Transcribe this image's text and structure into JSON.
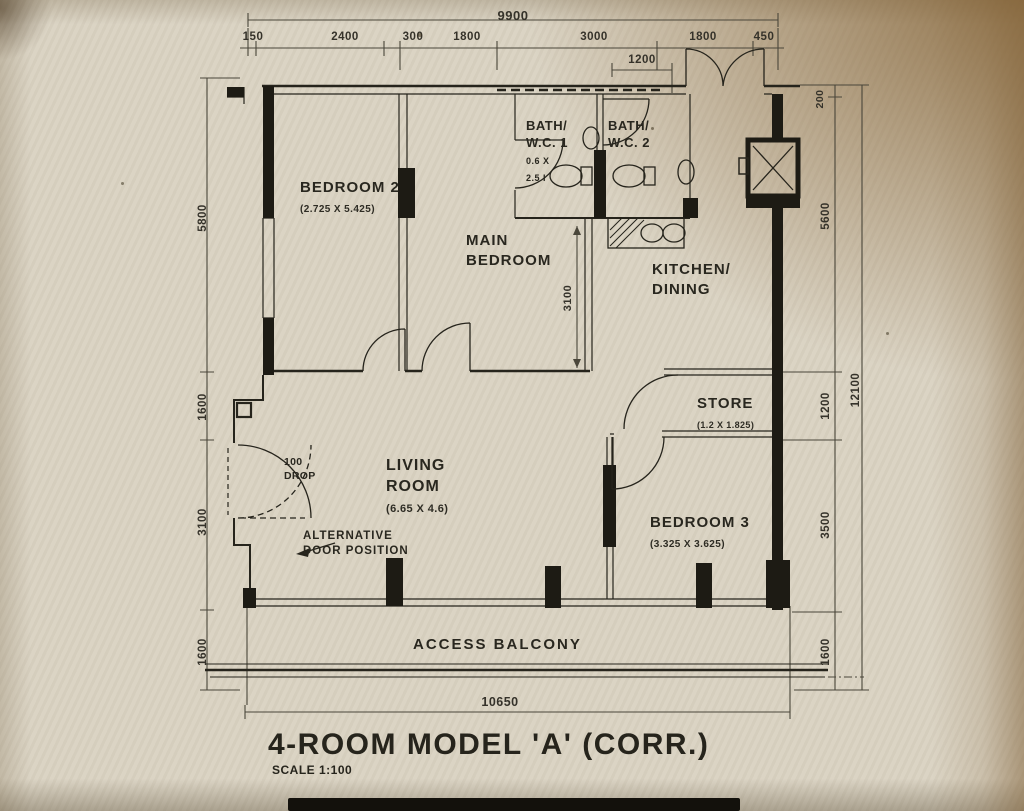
{
  "title": {
    "main": "4-ROOM MODEL 'A' (CORR.)",
    "scale": "SCALE 1:100"
  },
  "dimensions": {
    "top_total": "9900",
    "top_segments": [
      "150",
      "2400",
      "300",
      "1800",
      "3000",
      "1800",
      "450"
    ],
    "entrance_window": "1200",
    "wall_thickness": "200",
    "left_chain": [
      "5800",
      "1600",
      "3100",
      "1600"
    ],
    "right_chain": [
      "5600",
      "1200",
      "3500",
      "1600"
    ],
    "right_total": "12100",
    "balcony_length": "10650",
    "main_bedroom_width": "3100"
  },
  "rooms": {
    "bedroom2": {
      "name": "BEDROOM 2",
      "size": "(2.725 X 5.425)"
    },
    "main_bedroom": {
      "name_line1": "MAIN",
      "name_line2": "BEDROOM"
    },
    "bath_wc1": {
      "name_line1": "BATH/",
      "name_line2": "W.C. 1",
      "size_line1": "0.6 X",
      "size_line2": "2.5 I"
    },
    "bath_wc2": {
      "name_line1": "BATH/",
      "name_line2": "W.C. 2"
    },
    "kitchen_dining": {
      "name_line1": "KITCHEN/",
      "name_line2": "DINING"
    },
    "store": {
      "name": "STORE",
      "size": "(1.2 X 1.825)"
    },
    "living_room": {
      "name_line1": "LIVING",
      "name_line2": "ROOM",
      "size": "(6.65 X 4.6)"
    },
    "bedroom3": {
      "name": "BEDROOM 3",
      "size": "(3.325 X 3.625)"
    },
    "access_balcony": {
      "name": "ACCESS BALCONY"
    }
  },
  "annotations": {
    "drop_line1": "100",
    "drop_line2": "DROP",
    "alt_door_line1": "ALTERNATIVE",
    "alt_door_line2": "DOOR POSITION"
  }
}
